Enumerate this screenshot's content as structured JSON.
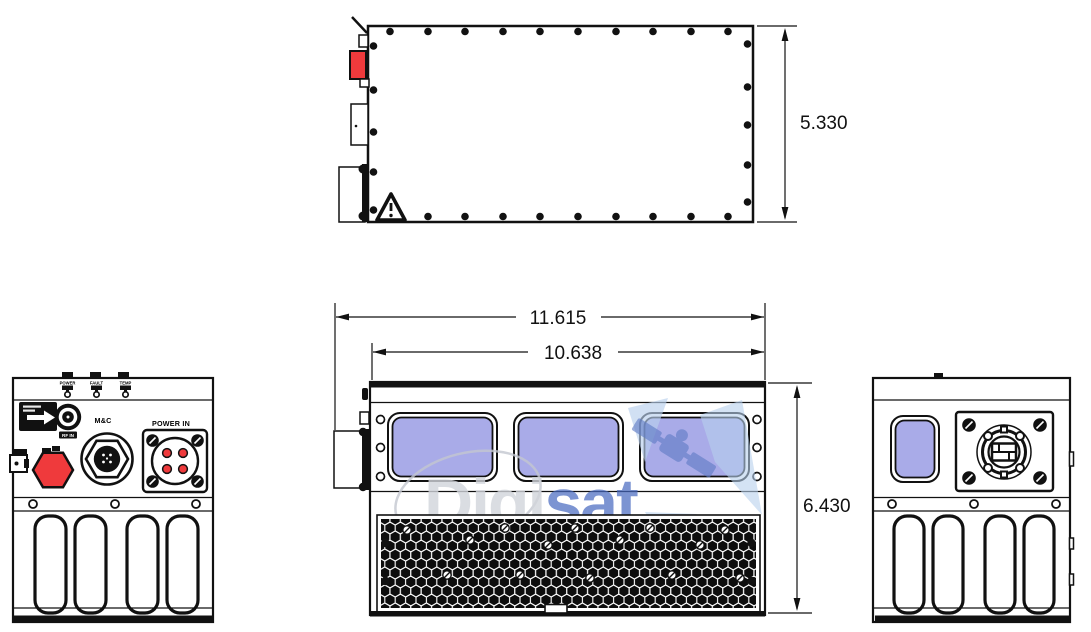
{
  "drawing": {
    "type": "technical-dimension-drawing",
    "views": [
      "top-view",
      "front-view",
      "left-end-view",
      "right-end-view"
    ],
    "dimensions": {
      "top_depth": "5.330",
      "overall_width": "11.615",
      "body_width": "10.638",
      "front_height": "6.430"
    }
  },
  "left_panel": {
    "leds": [
      {
        "label": "POWER"
      },
      {
        "label": "FAULT"
      },
      {
        "label": "TEMP"
      }
    ],
    "connectors": {
      "rf_label": "RF IN",
      "mc_label": "M&C",
      "power_label": "POWER IN"
    }
  },
  "watermark": {
    "word_gray": "Digi",
    "word_blue": "sat"
  },
  "colors": {
    "window_blue": "#a9abe8",
    "connector_red": "#ef3a3c",
    "watermark_gray": "#d2d5db",
    "watermark_blue": "#4668c0",
    "watermark_light_blue": "#b8d0ec",
    "watermark_satellite_blue": "#5f7bc5",
    "line_black": "#111111"
  }
}
